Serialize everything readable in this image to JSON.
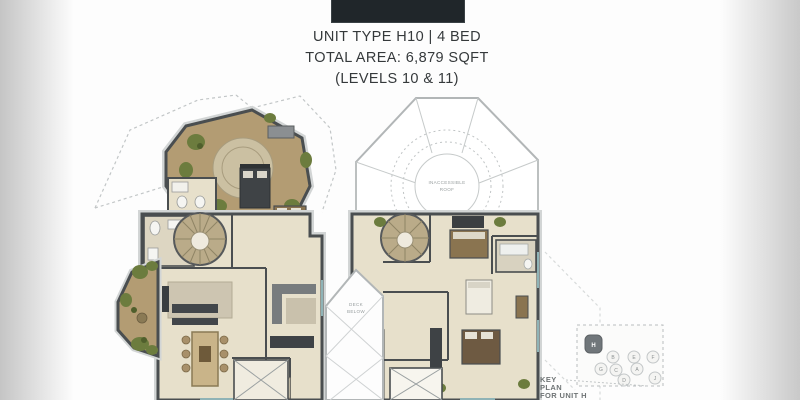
{
  "page": {
    "header": {
      "line1": "UNIT TYPE H10 | 4 BED",
      "line2": "TOTAL AREA: 6,879 SQFT",
      "line3": "(LEVELS 10 & 11)"
    },
    "floor_plans": {
      "right_plan_labels": {
        "roof_line1": "INACCESSIBLE",
        "roof_line2": "ROOF",
        "deck_line1": "DECK",
        "deck_line2": "BELOW"
      }
    },
    "key_plan": {
      "caption_line1": "KEY",
      "caption_line2": "PLAN",
      "caption_line3": "FOR UNIT H",
      "highlighted_unit": "H",
      "units": [
        {
          "label": "H"
        },
        {
          "label": "B"
        },
        {
          "label": "E"
        },
        {
          "label": "F"
        },
        {
          "label": "G"
        },
        {
          "label": "C"
        },
        {
          "label": "A"
        },
        {
          "label": "D"
        },
        {
          "label": "J"
        }
      ]
    },
    "colors": {
      "logo_block": "#20262a",
      "title_text": "#35393b",
      "wall": "#4a4e50",
      "deck_tan": "#b39c73",
      "interior_cream": "#e7e0cb",
      "plant_green": "#6c7c3e",
      "outline_gray": "#b2b6b7",
      "window_teal": "#8fb3b6"
    }
  }
}
